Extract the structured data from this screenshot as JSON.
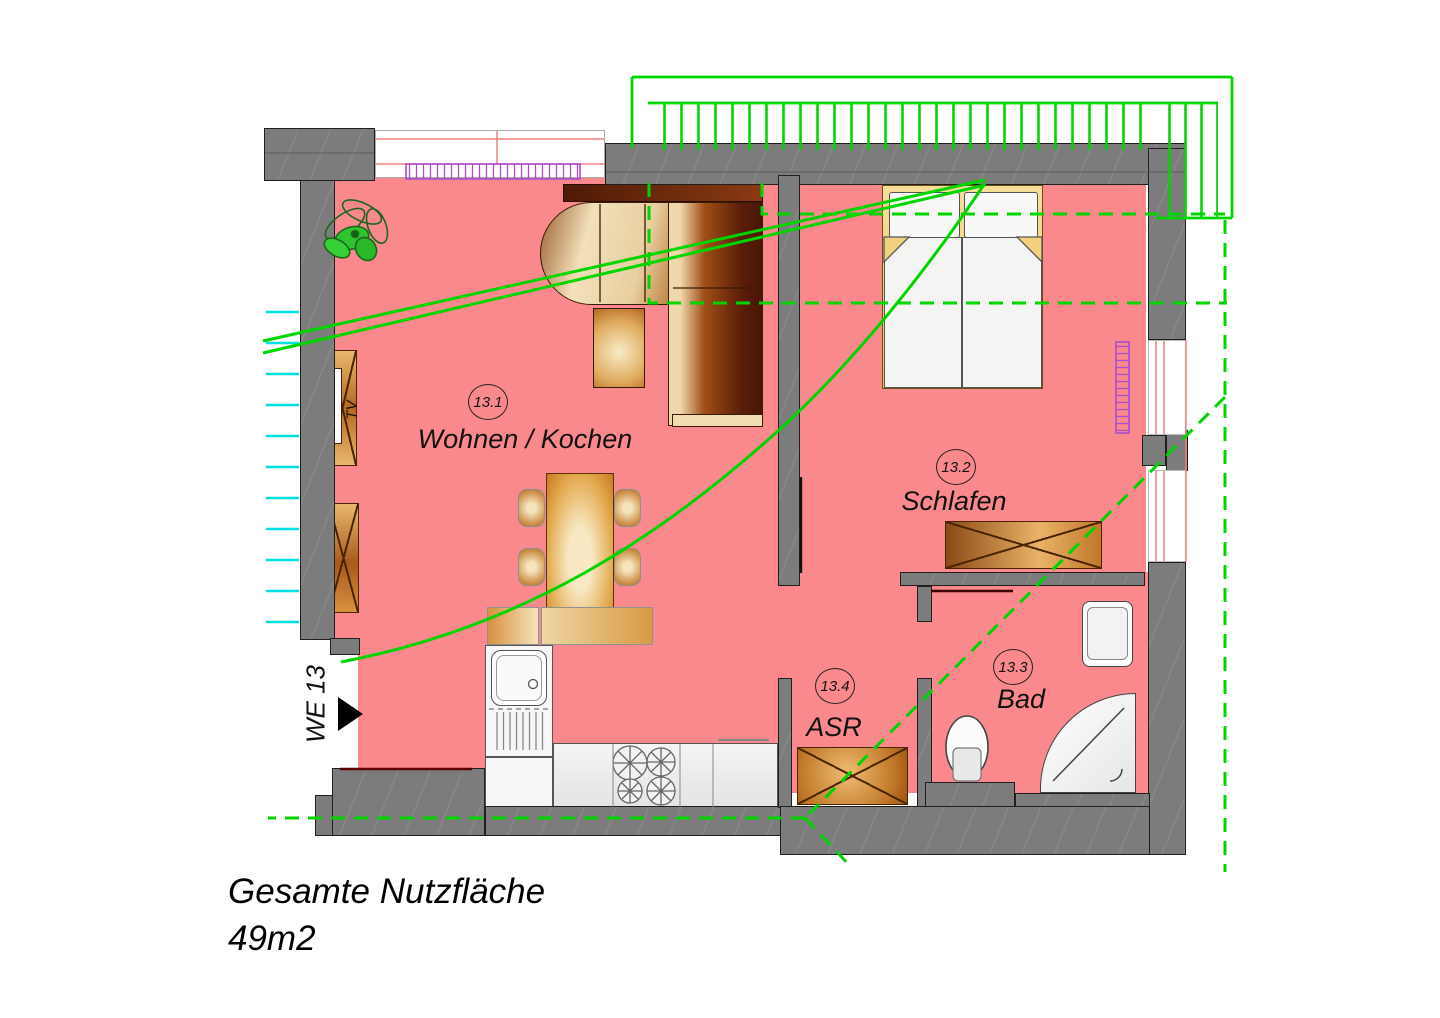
{
  "caption": {
    "line1": "Gesamte Nutzfläche",
    "line2": "49m2"
  },
  "entrance": {
    "label": "WE 13"
  },
  "rooms": [
    {
      "number": "13.1",
      "name": "Wohnen / Kochen"
    },
    {
      "number": "13.2",
      "name": "Schlafen"
    },
    {
      "number": "13.3",
      "name": "Bad"
    },
    {
      "number": "13.4",
      "name": "ASR"
    }
  ],
  "labels": {
    "tv": "TV"
  },
  "colors": {
    "floor": "#F9898C",
    "wall": "#7C7C7C",
    "wall_line": "#1F1F1F",
    "green": "#00D500",
    "cyan": "#00E0E0",
    "radiator": "#A94FD0",
    "win_pink": "#F08080",
    "wood_dark": "#5A1E08",
    "wood_mid": "#B5681F",
    "wood_light": "#F5E3BC",
    "bed_frame": "#F2D080",
    "fixture_line": "#555555",
    "text": "#111111"
  }
}
